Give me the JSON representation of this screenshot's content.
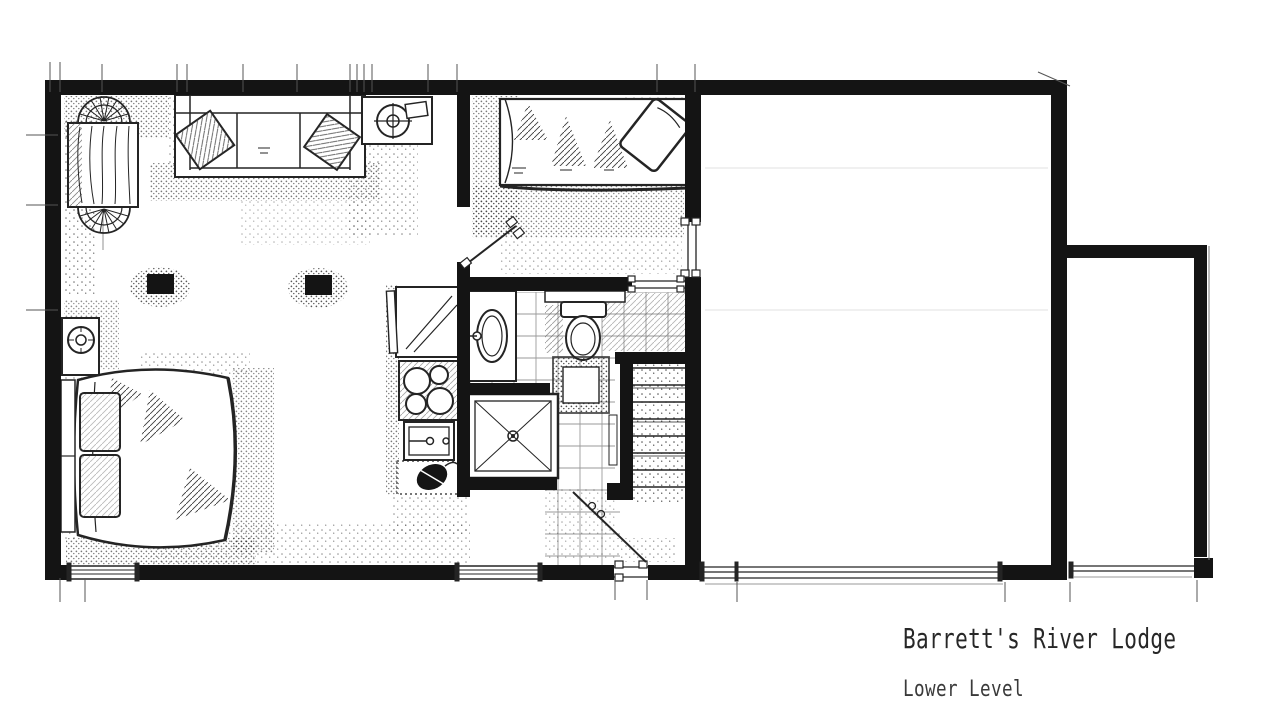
{
  "title_block": {
    "title": "Barrett's River Lodge",
    "subtitle": "Lower Level"
  },
  "colors": {
    "ink": "#1a1a1a",
    "paper": "#ffffff",
    "tile_line": "#9a9a9a"
  },
  "plan": {
    "rooms": [
      "living-area",
      "sleeping-area",
      "bedroom",
      "bathroom",
      "kitchenette",
      "stair-hall",
      "unfinished-room",
      "side-room"
    ],
    "furniture": [
      "dining-table",
      "dining-chair",
      "sofa",
      "throw-pillow",
      "wood-stove",
      "structural-post",
      "double-bed",
      "nightstand-with-lamp",
      "guest-bed",
      "refrigerator",
      "cooktop",
      "kitchen-sink",
      "counter-appliance",
      "vanity-sink",
      "toilet",
      "bath-mat",
      "shower",
      "staircase"
    ],
    "openings": [
      "window",
      "sliding-glass-door",
      "entry-door",
      "bedroom-door",
      "pocket-door"
    ]
  }
}
